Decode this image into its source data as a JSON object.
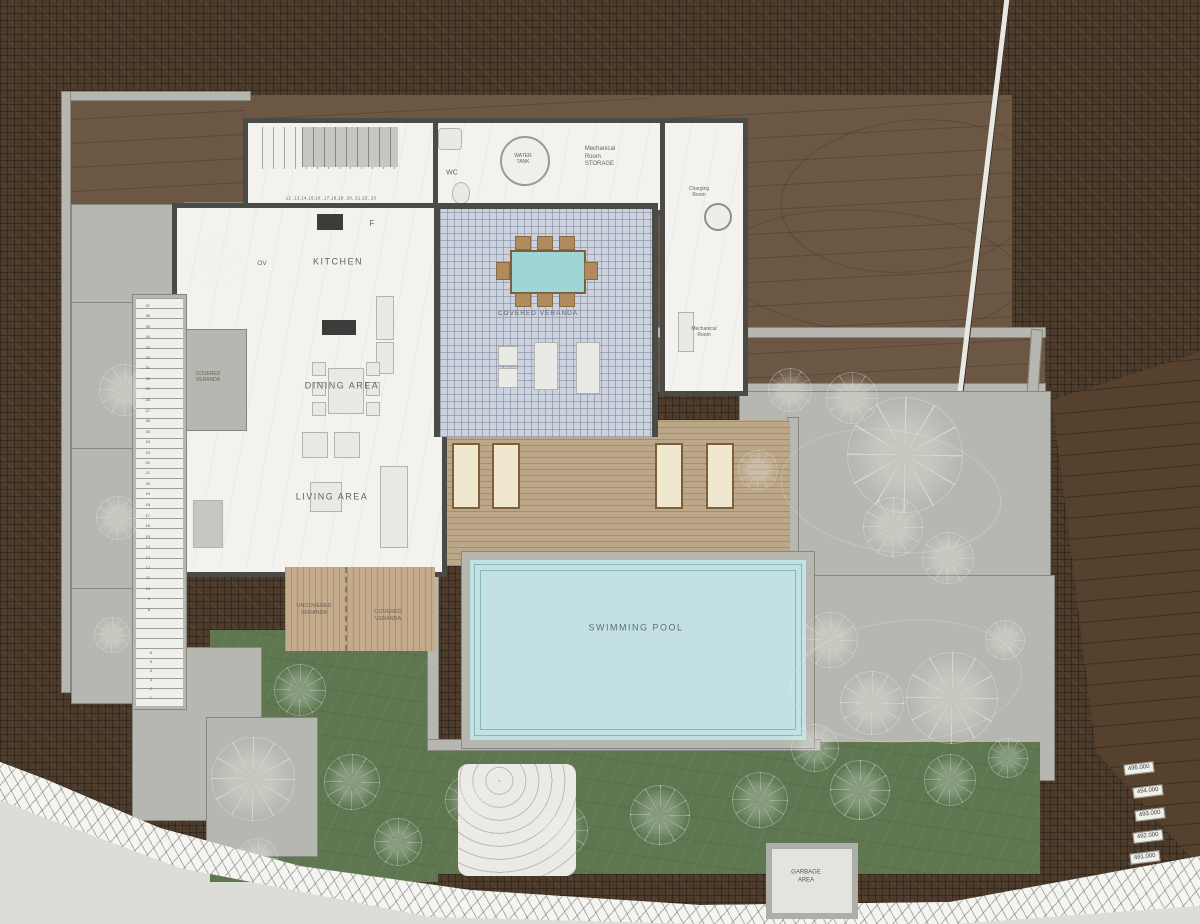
{
  "plan": {
    "rooms": {
      "kitchen": "KITCHEN",
      "dining": "DINING AREA",
      "living": "LIVING AREA",
      "wc": "WC",
      "water_tank": "WATER\nTANK",
      "mech_storage": "Mechanical\nRoom\nSTORAGE",
      "charging": "Charging\nRoom",
      "mechanical": "Mechanical\nRoom",
      "oven": "OV",
      "fridge": "F"
    },
    "outdoor": {
      "veranda_main": "COVERED VERANDA",
      "veranda_west": "COVERED\nVERANDA",
      "veranda_south": "COVERED\nVERANDA",
      "uncovered": "UNCOVERED\nVERANDA",
      "pool": "SWIMMING POOL",
      "garbage": "GARBAGE\nAREA"
    },
    "stairs": {
      "top_run": "12 ,13,14,15,16 ,17,18,19, 20, 21,22, 23",
      "west_a": "37\n36\n35\n34\n33\n32\n31\n30\n29\n28",
      "west_b": "27\n26\n25\n24\n23\n22\n21\n20\n19\n18",
      "west_c": "17\n16\n15\n14\n13\n12\n11\n10\n9\n8",
      "west_d": "6\n5\n4\n3\n2\n1"
    },
    "elevations": [
      "495.000",
      "494.000",
      "493.000",
      "492.000",
      "491.000"
    ],
    "colors": {
      "terrain": "#4c3a2a",
      "terrace": "#6c5644",
      "garden": "#5e7751",
      "pool_water": "#c3e1e2",
      "deck": "#bda789",
      "veranda_tile": "#ccd3de",
      "retaining_wall": "#b7b7b1",
      "house_wall": "#4a4a47"
    }
  }
}
